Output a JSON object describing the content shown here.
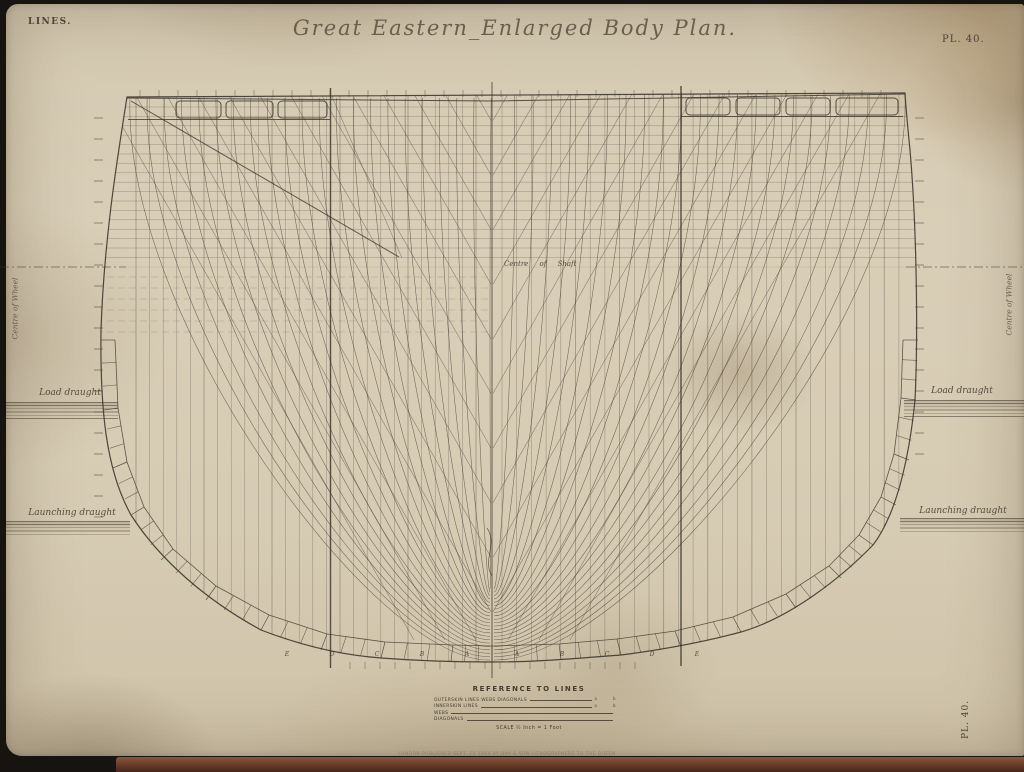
{
  "plate": {
    "corner_label": "LINES.",
    "title": "Great Eastern_Enlarged Body Plan.",
    "plate_number_top": "PL. 40.",
    "plate_number_side": "PL. 40."
  },
  "labels": {
    "load_draught_left": "Load draught",
    "load_draught_right": "Load draught",
    "launching_draught_left": "Launching draught",
    "launching_draught_right": "Launching draught",
    "centre_of_shaft": "Centre  of  Shaft",
    "centre_of_wheel_left": "Centre of Wheel",
    "centre_of_wheel_right": "Centre of Wheel"
  },
  "legend": {
    "title": "REFERENCE TO LINES",
    "rows": [
      {
        "label": "OUTERSKIN LINES WEBS DIAGONALS",
        "mark": "a b"
      },
      {
        "label": "INNERSKIN LINES",
        "mark": "a b"
      },
      {
        "label": "WEBS",
        "mark": ""
      },
      {
        "label": "DIAGONALS",
        "mark": ""
      }
    ],
    "scale": "SCALE ½ Inch = 1 Foot"
  },
  "imprint": "LONDON PUBLISHED SEPT. 15 1864 BY DAY & SON LITHOGRAPHERS TO THE QUEEN",
  "keel_cells": [
    "E",
    "D",
    "C",
    "B",
    "A",
    "A",
    "B",
    "C",
    "D",
    "E"
  ],
  "colors": {
    "paper": "#d6cbb3",
    "ink": "#3e372c",
    "faint": "#6b6253",
    "band": "#6e402c"
  }
}
